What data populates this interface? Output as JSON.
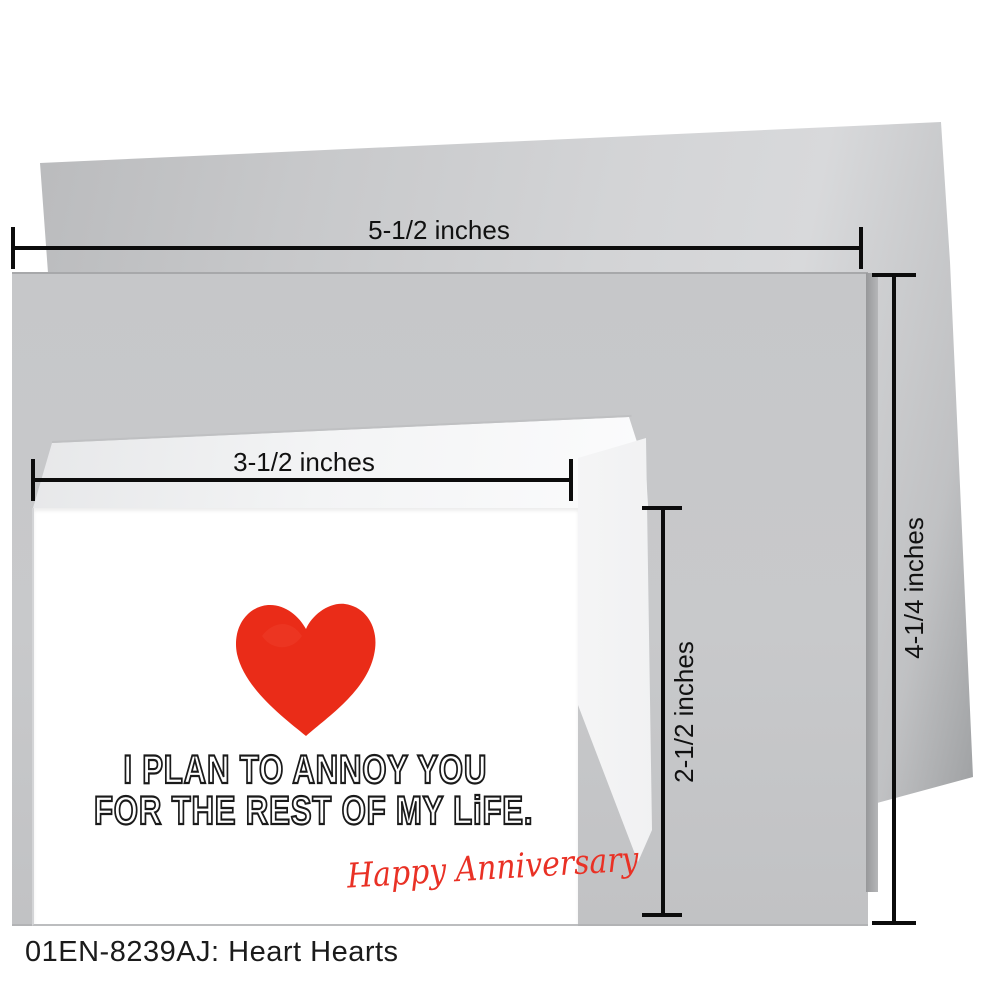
{
  "product_caption": "01EN-8239AJ: Heart Hearts",
  "measurements": {
    "envelope_width_label": "5-1/2 inches",
    "envelope_height_label": "4-1/4 inches",
    "card_width_label": "3-1/2 inches",
    "card_height_label": "2-1/2 inches"
  },
  "card": {
    "message_line1": "I PLAN TO ANNOY YOU",
    "message_line2": "FOR THE REST OF MY LiFE.",
    "signature": "Happy Anniversary",
    "heart_icon": "red crayon heart"
  },
  "colors": {
    "envelope_gray": "#c6c7c9",
    "flap_gray_light": "#d8d9db",
    "flap_gray_dark": "#b2b3b5",
    "card_white": "#ffffff",
    "heart_red": "#ea2c18",
    "script_red": "#e93125",
    "line_black": "#0c0c0c"
  }
}
